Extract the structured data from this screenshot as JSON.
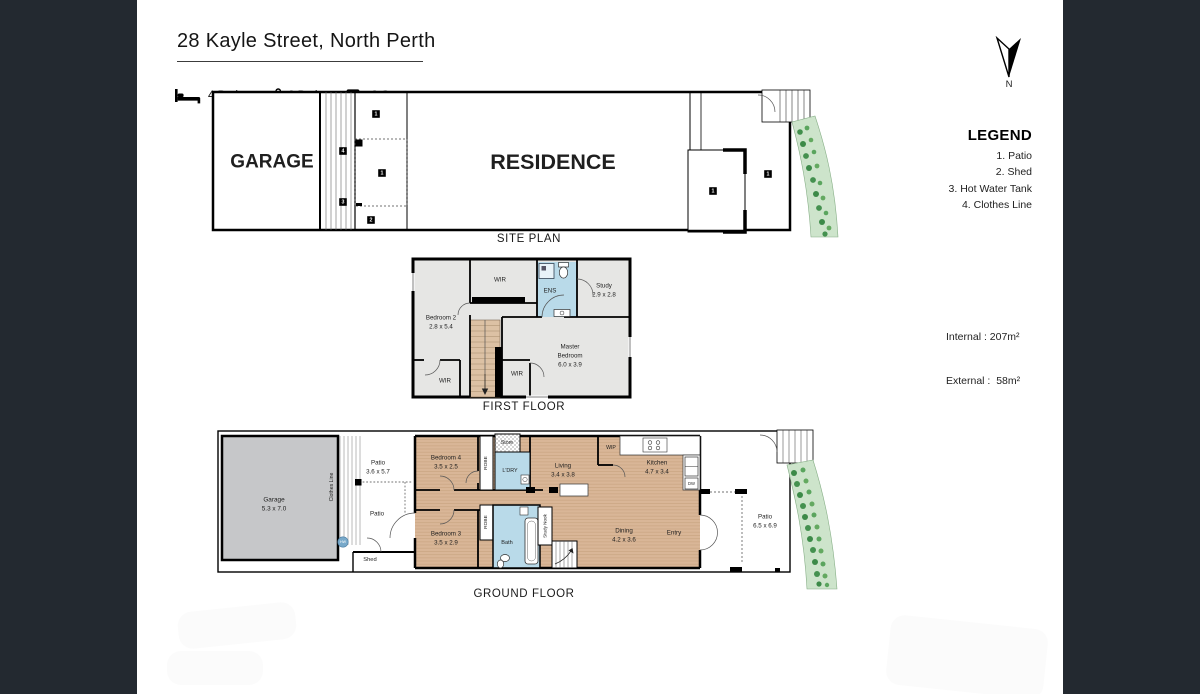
{
  "header": {
    "title": "28 Kayle Street, North Perth",
    "features": {
      "beds": "4 Bed",
      "baths": "2 Bath",
      "cars": "2 Car"
    }
  },
  "compass": {
    "label": "N"
  },
  "legend": {
    "title": "LEGEND",
    "items": [
      "1. Patio",
      "2. Shed",
      "3. Hot Water Tank",
      "4. Clothes Line"
    ]
  },
  "areas": {
    "internal": "Internal : 207m²",
    "external": "External :  58m²"
  },
  "site_plan": {
    "label": "SITE PLAN",
    "garage": "GARAGE",
    "residence": "RESIDENCE",
    "markers": {
      "patio": "1",
      "shed": "2",
      "hot_water_tank": "3",
      "clothes_line": "4"
    }
  },
  "first_floor": {
    "label": "FIRST FLOOR",
    "rooms": {
      "bedroom2": {
        "name": "Bedroom 2",
        "dims": "2.8 x 5.4"
      },
      "wir_top": "WIR",
      "wir_left": "WIR",
      "wir_mid": "WIR",
      "ens": "ENS",
      "study": {
        "name": "Study",
        "dims": "2.9 x 2.8"
      },
      "master": {
        "name1": "Master",
        "name2": "Bedroom",
        "dims": "6.0 x 3.9"
      }
    }
  },
  "ground_floor": {
    "label": "GROUND FLOOR",
    "rooms": {
      "garage": {
        "name": "Garage",
        "dims": "5.3 x 7.0"
      },
      "clothes_line": "Clothes Line",
      "patio_rear": {
        "name": "Patio",
        "dims": "3.6 x 5.7"
      },
      "patio_mid": "Patio",
      "shed": "Shed",
      "hot_water": "HW",
      "bedroom4": {
        "name": "Bedroom 4",
        "dims": "3.5 x 2.5"
      },
      "robe4": "ROBE",
      "store": "Store",
      "laundry": "L'DRY",
      "bedroom3": {
        "name": "Bedroom 3",
        "dims": "3.5 x 2.9"
      },
      "robe3": "ROBE",
      "bath": "Bath",
      "study_nook": "Study Nook",
      "living": {
        "name": "Living",
        "dims": "3.4 x 3.8"
      },
      "wip": "WIP",
      "kitchen": {
        "name": "Kitchen",
        "dims": "4.7 x 3.4"
      },
      "dishwasher": "DW",
      "dining": {
        "name": "Dining",
        "dims": "4.2 x 3.6"
      },
      "entry": "Entry",
      "patio_front": {
        "name": "Patio",
        "dims": "6.5 x 6.9"
      }
    }
  },
  "colors": {
    "band": "#232930",
    "floor_gray": "#e6e6e4",
    "wood": "#d9b697",
    "water_blue": "#b9dae9",
    "garage_gray": "#c6c7c9",
    "garden_bed": "#cde4cb",
    "plant_green": "#44914f"
  }
}
